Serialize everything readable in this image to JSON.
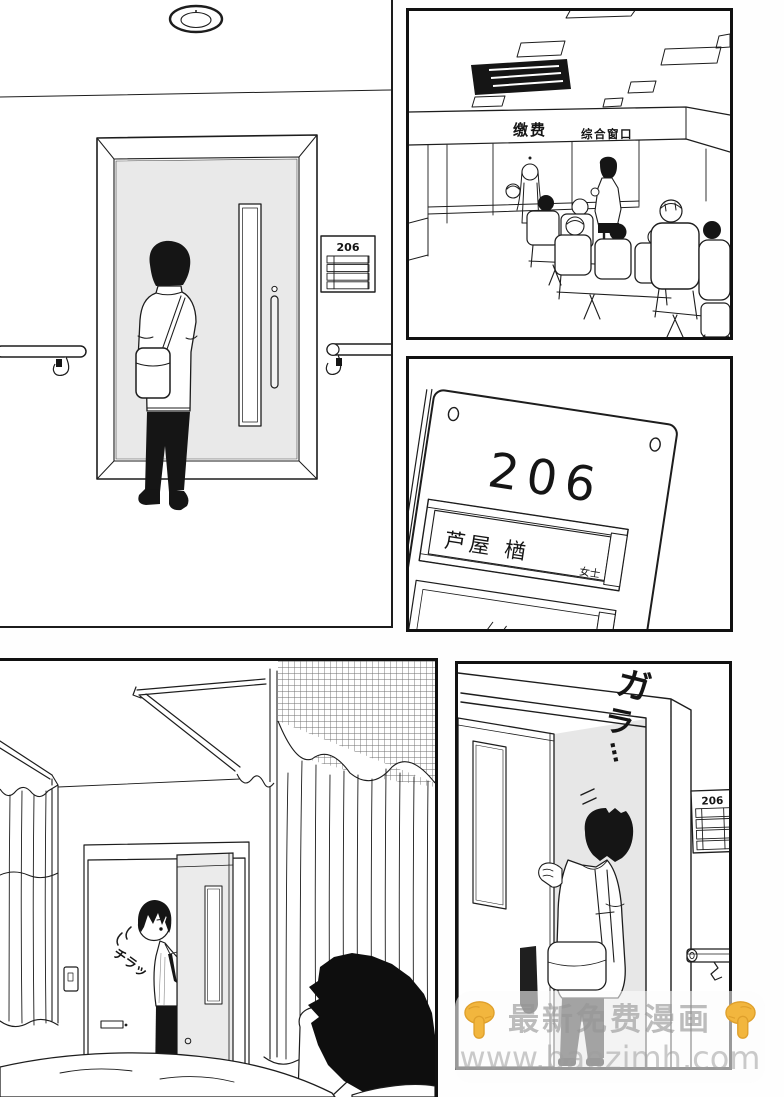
{
  "panels": {
    "waiting_room": {
      "sign_payment": "缴费",
      "sign_general_window": "综合窗口"
    },
    "hallway": {
      "room_sign_number": "206"
    },
    "nameplate": {
      "room_number": "206",
      "patient_name": "芦屋 楢",
      "honorific": "女士"
    },
    "hospital_room": {
      "sfx_peek": "チラッ"
    },
    "room_entrance": {
      "sfx_door_slide_char1": "ガ",
      "sfx_door_slide_char2": "ラ",
      "sfx_trail_dots": "…",
      "room_sign_number": "206"
    }
  },
  "watermark": {
    "title": "最新免费漫画",
    "url": "www.baozimh.com",
    "pointer_icon": "pointing-down-hand",
    "hand_color": "#F2B63E",
    "hand_edge_color": "#DFA02C",
    "text_color": "#9a9a9a"
  }
}
